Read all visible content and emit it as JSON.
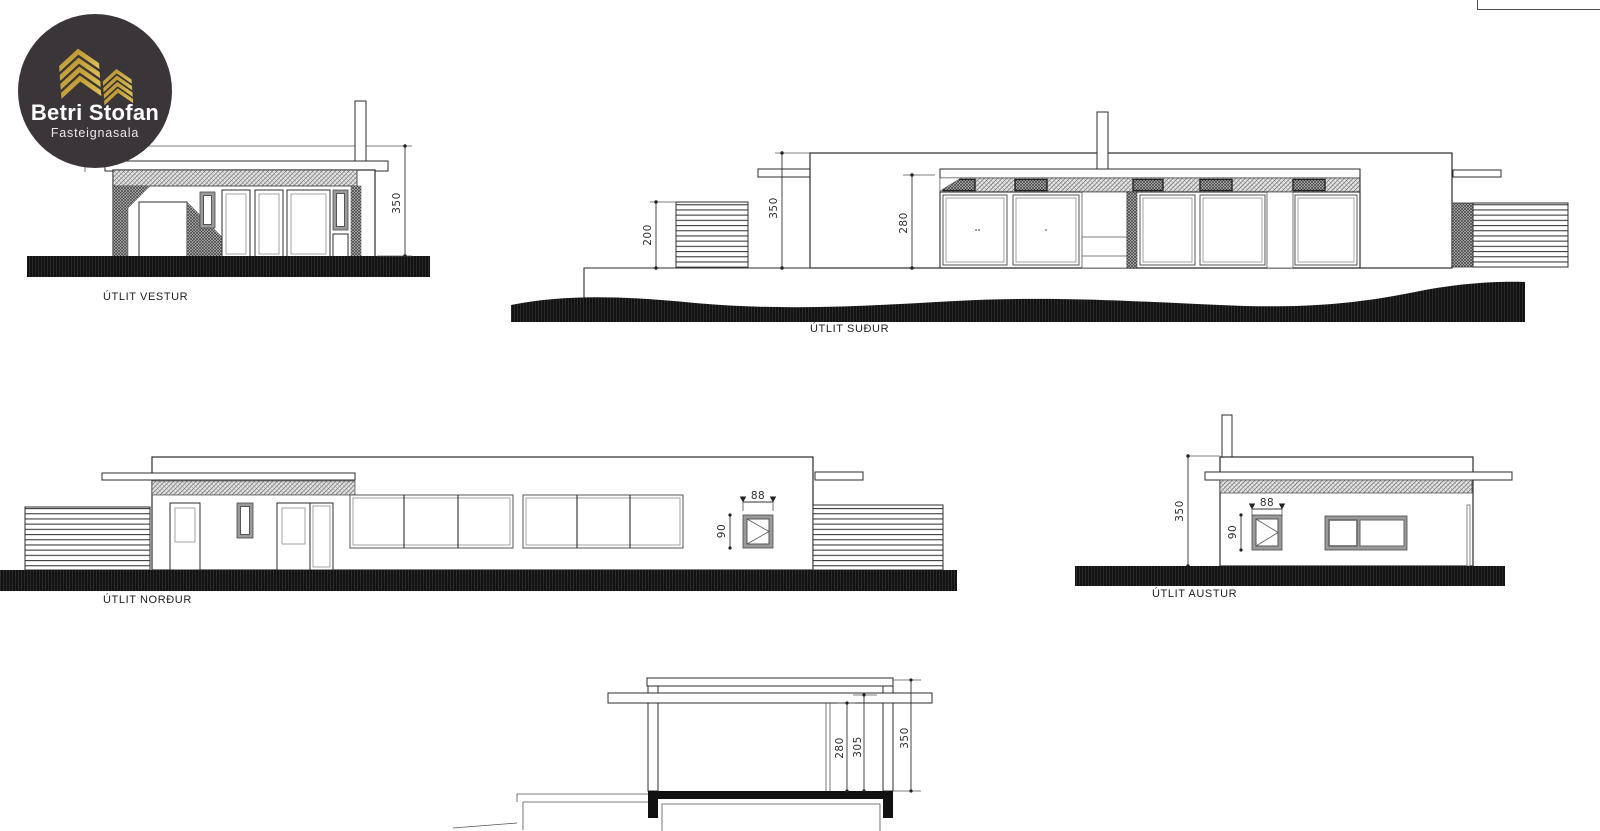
{
  "logo": {
    "title": "Betri Stofan",
    "subtitle": "Fasteignasala",
    "circle_color": "#3a3539",
    "gold_color": "#c9a42f"
  },
  "drawings": {
    "west": {
      "label": "ÚTLIT VESTUR",
      "dims": {
        "total_height": "350"
      }
    },
    "south": {
      "label": "ÚTLIT SUÐUR",
      "dims": {
        "fence_height": "200",
        "total_height": "350",
        "glass_height": "280"
      }
    },
    "north": {
      "label": "ÚTLIT NORÐUR",
      "dims": {
        "hatch_window_width": "88",
        "hatch_window_height": "90"
      }
    },
    "east": {
      "label": "ÚTLIT AUSTUR",
      "dims": {
        "total_height": "350",
        "hatch_window_width": "88",
        "hatch_window_height": "90"
      }
    },
    "section": {
      "dims": {
        "ceiling_height": "280",
        "roof_underside": "305",
        "total_height": "350"
      }
    }
  }
}
